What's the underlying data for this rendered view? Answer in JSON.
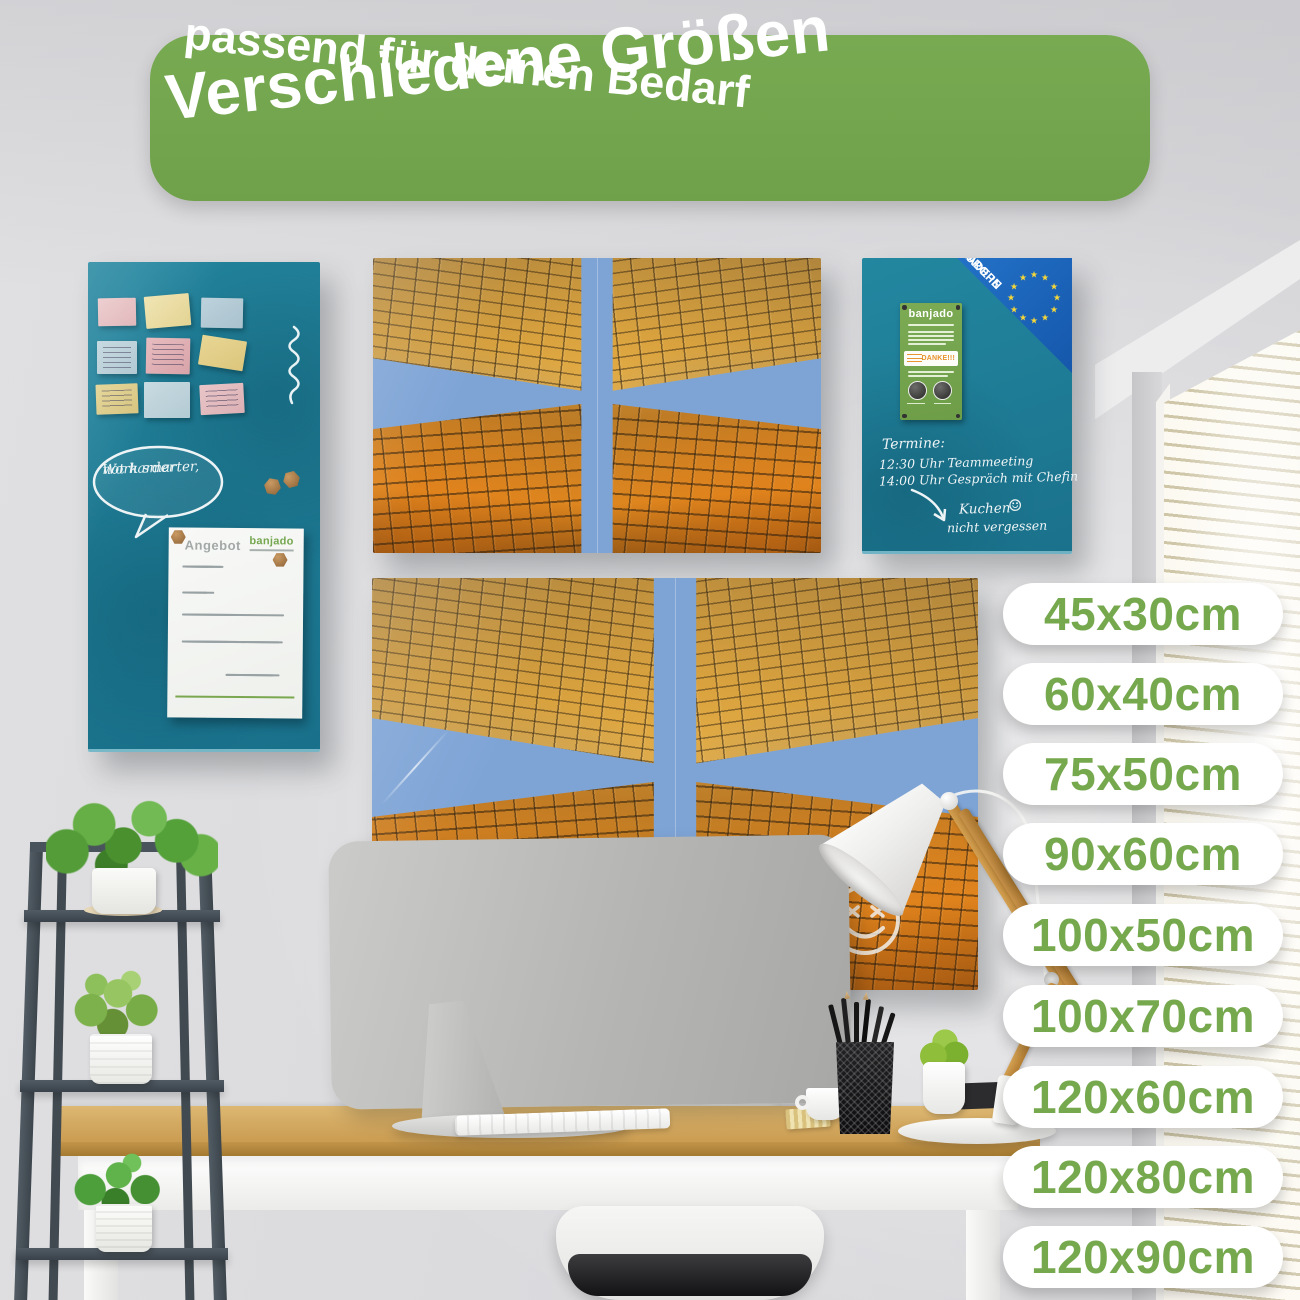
{
  "banner": {
    "title": "Verschiedene Größen",
    "subtitle": "passend für deinen Bedarf"
  },
  "sizes": [
    "45x30cm",
    "60x40cm",
    "75x50cm",
    "90x60cm",
    "100x50cm",
    "100x70cm",
    "120x60cm",
    "120x80cm",
    "120x90cm"
  ],
  "memo_board": {
    "bubble_line1": "Work smarter,",
    "bubble_line2": "not harder",
    "doc_title": "Angebot",
    "doc_brand": "banjado"
  },
  "notes_board": {
    "brand": "banjado",
    "made_in_line1": "MADE IN",
    "made_in_line2": "EUROPE",
    "thanks": "DANKE!!!",
    "schedule_title": "Termine:",
    "schedule_item1": "12:30 Uhr Teammeeting",
    "schedule_item2": "14:00 Uhr Gespräch mit Chefin",
    "reminder_line1": "Kuchen",
    "reminder_line2": "nicht vergessen",
    "smiley": "☺",
    "star": "★"
  },
  "colors": {
    "accent_green": "#74a74f",
    "pill_text_green": "#76a84e",
    "board_teal": "#1e7d96",
    "eu_blue": "#1b66bd"
  }
}
